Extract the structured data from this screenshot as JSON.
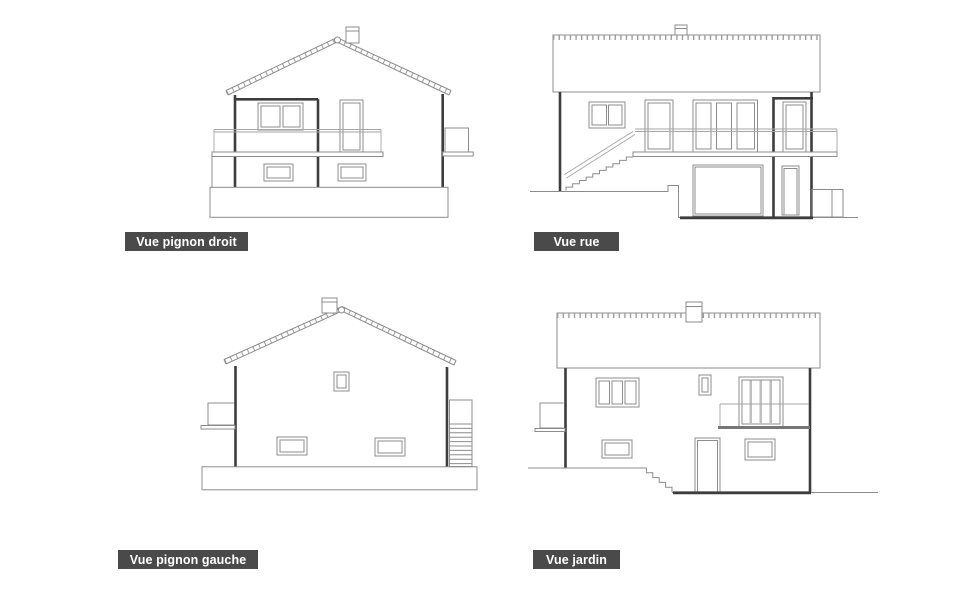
{
  "sheet": {
    "background": "#ffffff",
    "drawing_line_color": "#8c8c8c",
    "cut_wall_line_color": "#3d3d3d",
    "label_background": "#4a4a4a",
    "label_text_color": "#ffffff"
  },
  "views": [
    {
      "id": "vue-pignon-droit",
      "label": "Vue pignon droit",
      "position": "top-left"
    },
    {
      "id": "vue-rue",
      "label": "Vue rue",
      "position": "top-right"
    },
    {
      "id": "vue-pignon-gauche",
      "label": "Vue pignon gauche",
      "position": "bottom-left"
    },
    {
      "id": "vue-jardin",
      "label": "Vue jardin",
      "position": "bottom-right"
    }
  ]
}
